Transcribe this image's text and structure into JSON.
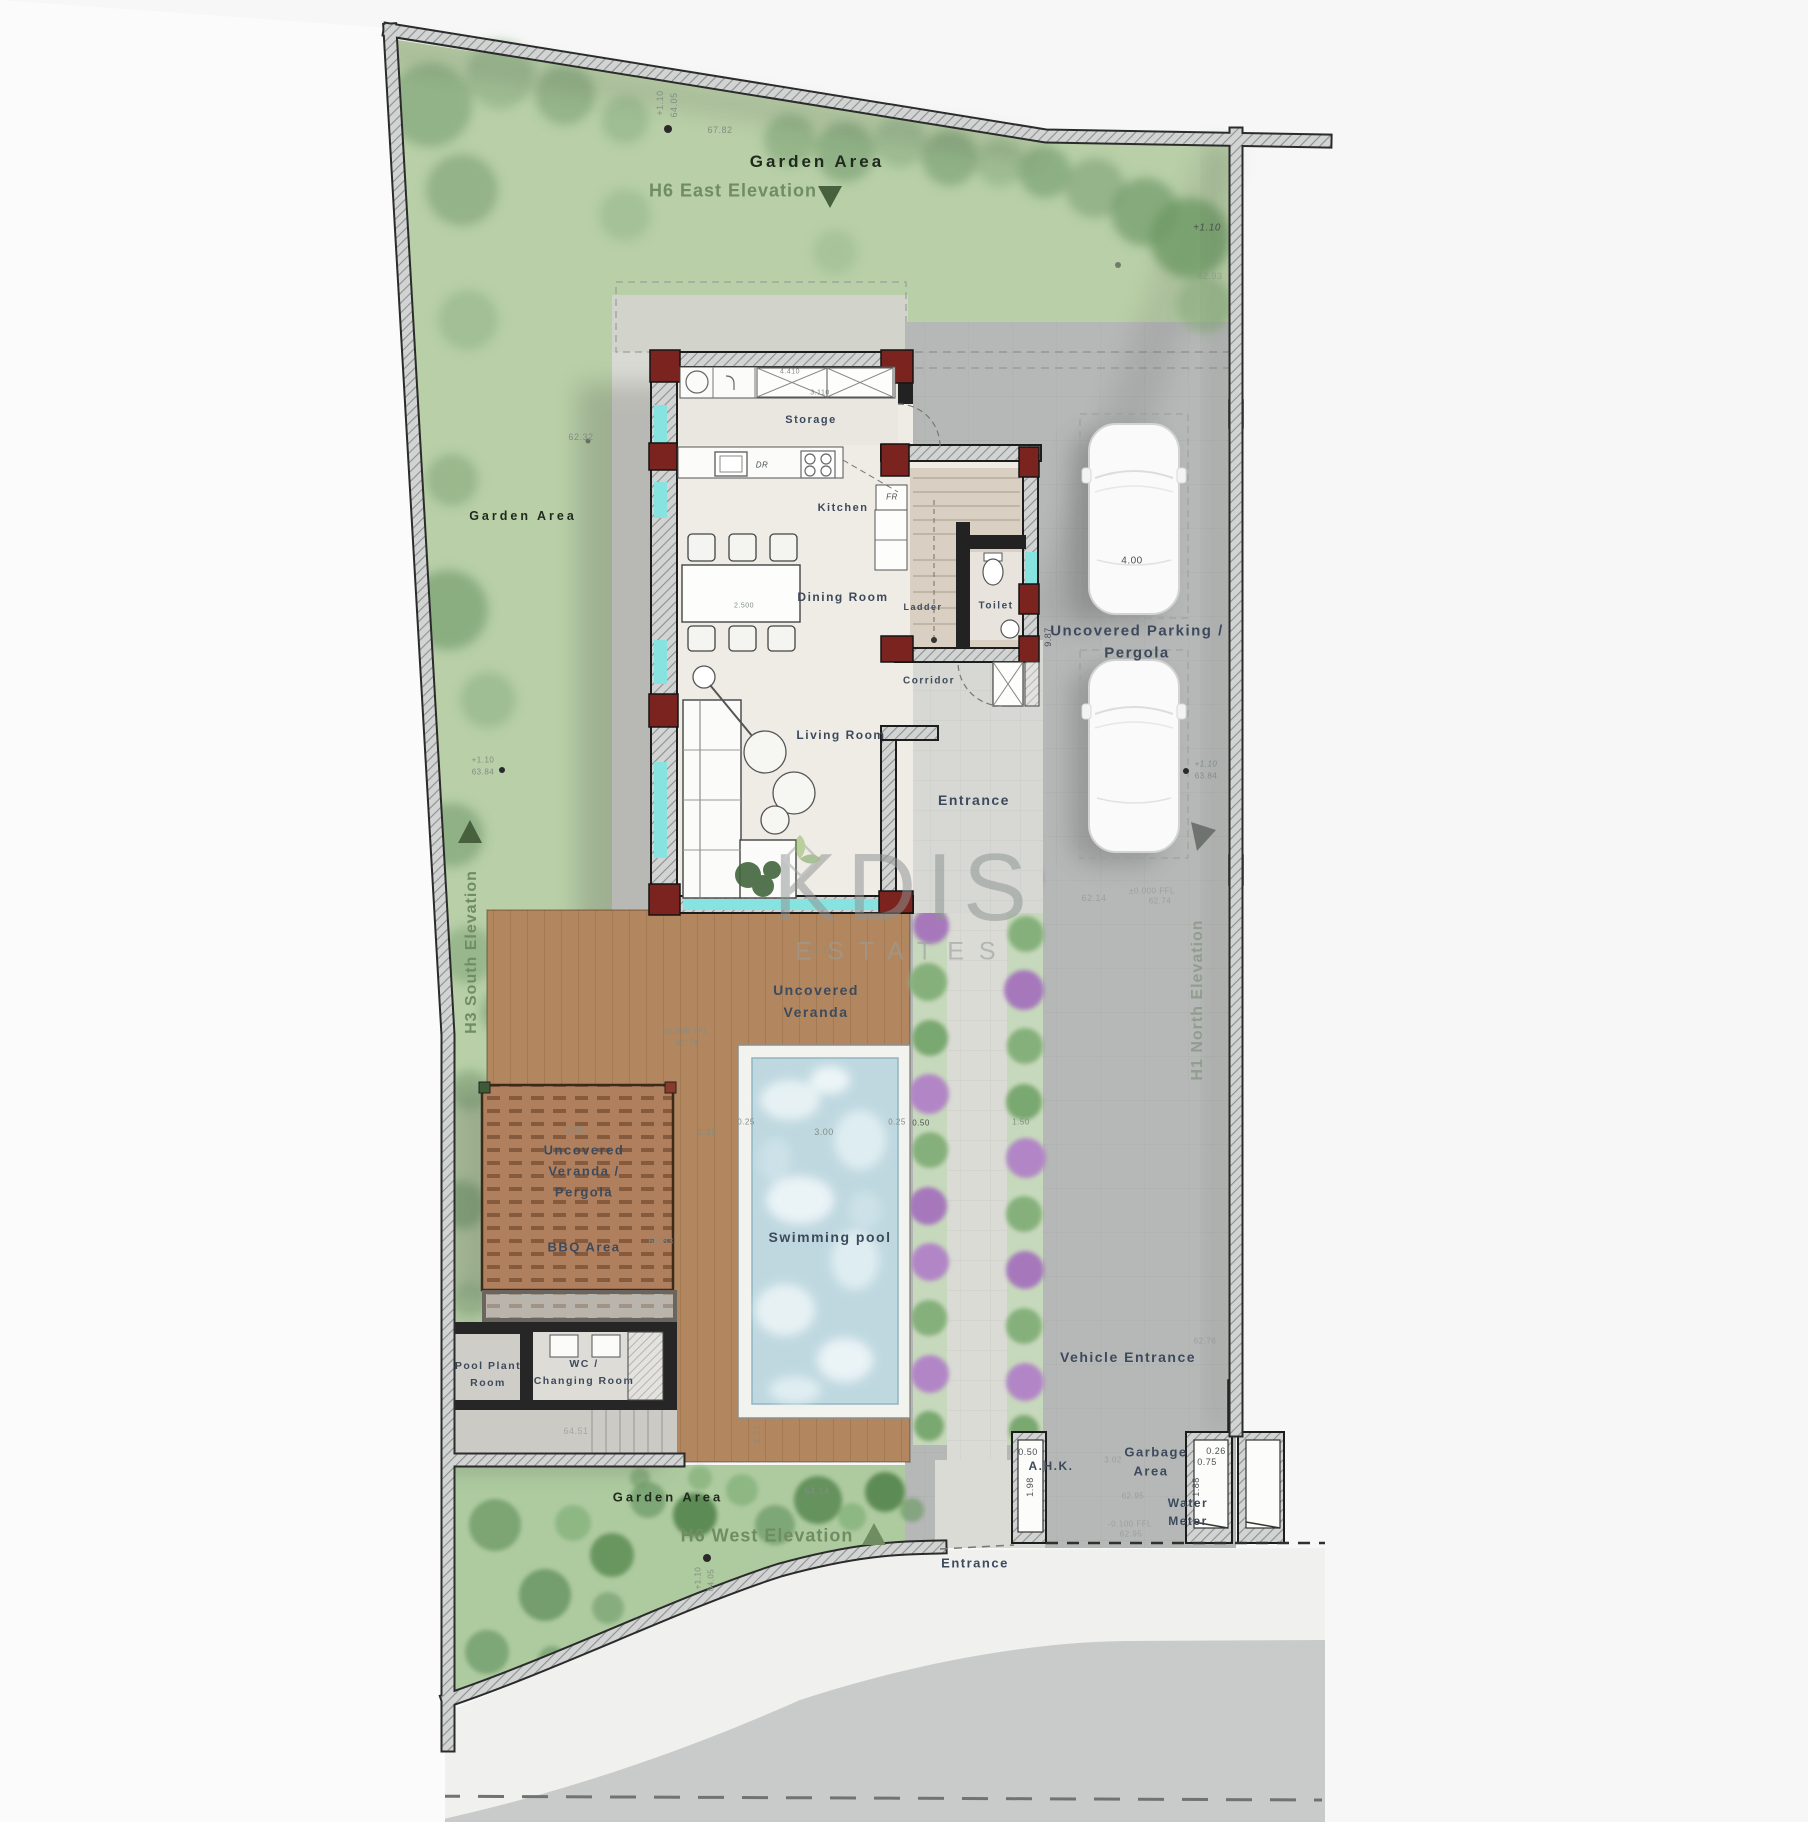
{
  "plan": {
    "garden": {
      "top": "Garden Area",
      "left": "Garden Area",
      "bottom": "Garden Area"
    },
    "elevations": {
      "east": "H6 East Elevation",
      "west": "H6 West Elevation",
      "south": "H3 South Elevation",
      "north": "H1 North Elevation"
    },
    "rooms": {
      "storage": "Storage",
      "kitchen": "Kitchen",
      "dining": "Dining Room",
      "ladder": "Ladder",
      "toilet": "Toilet",
      "corridor": "Corridor",
      "living": "Living Room",
      "entrance": "Entrance",
      "fridge": "FR",
      "dr": "DR"
    },
    "outdoor": {
      "veranda_l1": "Uncovered",
      "veranda_l2": "Veranda",
      "pool": "Swimming pool",
      "pergola_l1": "Uncovered",
      "pergola_l2": "Veranda /",
      "pergola_l3": "Pergola",
      "bbq": "BBQ Area",
      "pool_plant_l1": "Pool Plant",
      "pool_plant_l2": "Room",
      "wc_l1": "WC /",
      "wc_l2": "Changing Room",
      "parking_l1": "Uncovered Parking /",
      "parking_l2": "Pergola",
      "vehicle_entrance": "Vehicle Entrance",
      "entrance_bottom": "Entrance",
      "ahk": "A.H.K.",
      "garbage_l1": "Garbage",
      "garbage_l2": "Area",
      "water_l1": "Water",
      "water_l2": "Meter"
    },
    "dims": {
      "t_plus": "+1.10",
      "t_lvl": "64.05",
      "t_len": "67.82",
      "tr_plus": "+1.10",
      "tr_lvl": "62.93",
      "left_lvl": "62.32",
      "stair_d": "9.87",
      "car_d": "4.00",
      "ml_plus": "+1.10",
      "ml_lvl": "63.84",
      "mr_plus": "+1.10",
      "mr_lvl": "63.84",
      "ffl_deck": "±0.000 FFL",
      "ffl_deck_lvl": "62.74",
      "park_lvl": "62.14",
      "ffl_park": "±0.000 FFL",
      "ffl_park_lvl": "62.74",
      "deck_lvl": "62.31",
      "p398": "3.98",
      "p135": "1.35",
      "p025a": "0.25",
      "p300": "3.00",
      "p025b": "0.25",
      "p050": "0.50",
      "p150": "1.50",
      "bbq_lvl": "63.83",
      "ramp_lvl": "64.51",
      "p121": "1.21",
      "bot_lvl": "64.14",
      "b_plus": "+1.10",
      "b_lvl": "64.05",
      "ahk_w": "0.50",
      "ahk_h": "1.98",
      "g_302": "3.02",
      "g_lvl": "62.95",
      "g_ffl": "-0.100 FFL",
      "g_lvl2": "62.95",
      "wm_a": "0.26",
      "wm_b": "0.75",
      "wm_h": "1.88",
      "ve_lvl": "62.76",
      "table_d": "2.500",
      "st_a": "4.410",
      "st_b": "3.110"
    },
    "watermark": {
      "part1": "K",
      "part2": "DIS",
      "subtitle": "ESTATES"
    },
    "colors": {
      "garden": "#b8cfa7",
      "wall": "#c9cbc9",
      "parking": "#b6b8b7",
      "deck": "#b0835f",
      "pergola": "#a87c55",
      "pool": "#bfd8e0",
      "window": "#86e3df",
      "column": "#7b241f",
      "label": "#3d4a5c",
      "elevation": "#6f8d60",
      "bush_purple": "#b286c6",
      "bush_green": "#85b07b"
    }
  }
}
